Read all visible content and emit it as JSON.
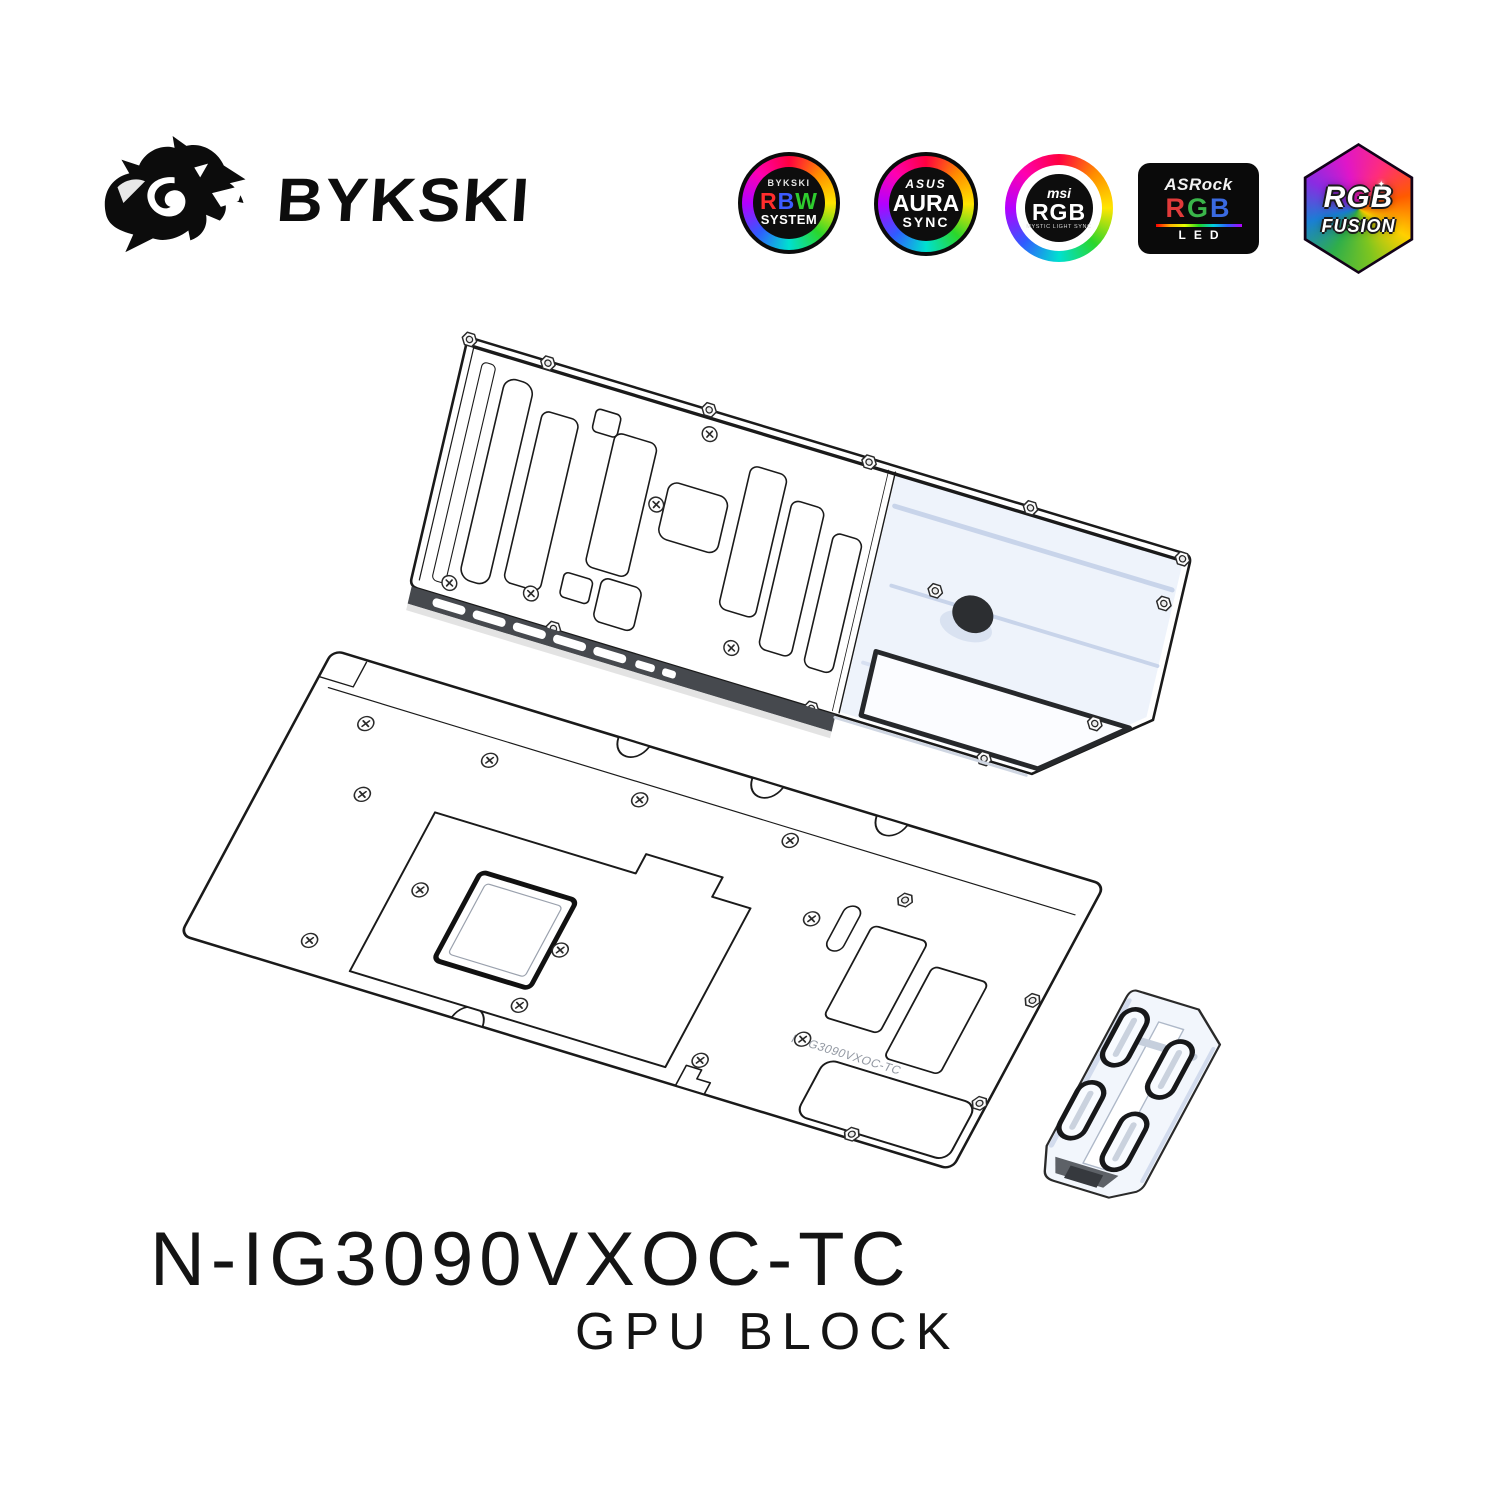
{
  "brand": {
    "wordmark": "BYKSKI",
    "logo_icon": "dragon-head"
  },
  "logos": {
    "rbw": {
      "brand": "BYKSKI",
      "r": "R",
      "b": "B",
      "w": "W",
      "sub": "SYSTEM"
    },
    "aura": {
      "brand": "ASUS",
      "main": "AURA",
      "sub": "SYNC"
    },
    "msi": {
      "brand": "msi",
      "main": "RGB",
      "sub": "MYSTIC LIGHT SYNC"
    },
    "asrock": {
      "brand": "ASRock",
      "r": "R",
      "g": "G",
      "b": "B",
      "sub": "LED"
    },
    "fusion": {
      "main": "RGB",
      "sub": "FUSION",
      "sparkle": "✦"
    }
  },
  "product": {
    "model": "N-IG3090VXOC-TC",
    "category": "GPU BLOCK",
    "engraving": "N-IG3090VXOC-TC"
  },
  "colors": {
    "line": "#1a1a1a",
    "acrylic_tint": "#ccd7eb",
    "port_dark": "#2c2e31",
    "rbw_r": "#ff2d2d",
    "rbw_b": "#3d5bff",
    "rbw_w": "#2ecc2e",
    "asrock_r": "#e03a3a",
    "asrock_g": "#3ab54a",
    "asrock_b": "#3a6ae0"
  }
}
